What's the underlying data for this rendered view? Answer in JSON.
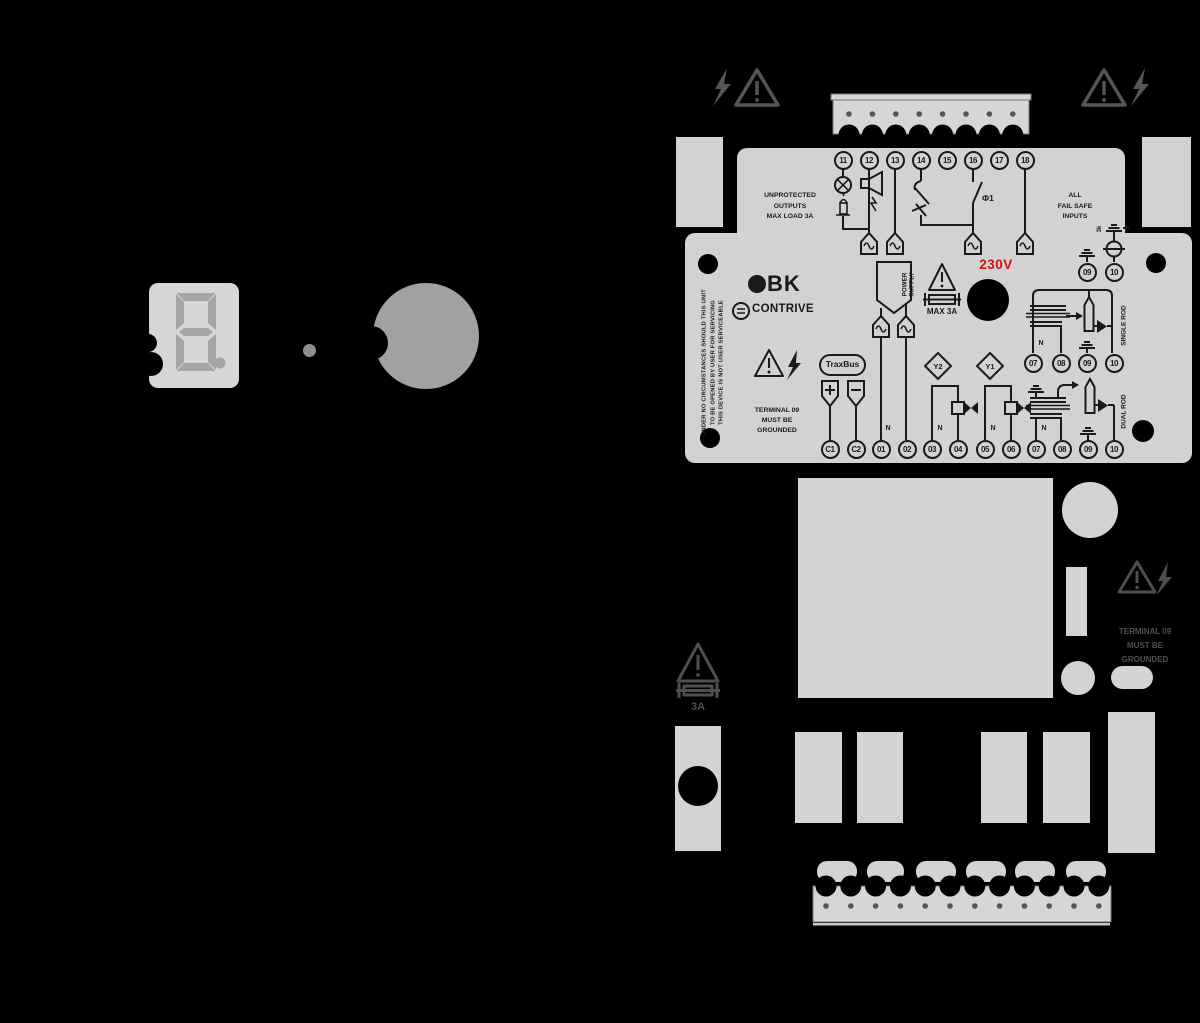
{
  "display": {
    "value": "8."
  },
  "brand": {
    "logo": "BK",
    "company": "CONTRIVE"
  },
  "labels": {
    "unprotected": [
      "UNPROTECTED",
      "OUTPUTS",
      "MAX LOAD 3A"
    ],
    "failsafe": [
      "ALL",
      "FAIL SAFE",
      "INPUTS"
    ],
    "ground_warning": [
      "TERMINAL 09",
      "MUST BE",
      "GROUNDED"
    ],
    "disclaimer": [
      "UNDER NO CIRCUMSTANCES SHOULD THIS UNIT",
      "TO BE OPENED BY USER FOR SERVICING",
      "THIS DEVICE IS NOT USER SERVICEABLE"
    ],
    "power_supply": [
      "POWER",
      "SUPPLY"
    ],
    "voltage": "230V",
    "max_current": "MAX 3A",
    "traxbus": "TraxBus",
    "phase": "Φ1",
    "single_rod": "SINGLE ROD",
    "dual_rod": "DUAL ROD",
    "spark_gap": "3k",
    "fuse_rating": "3A",
    "neutral": "N",
    "valve_y1": "Y1",
    "valve_y2": "Y2"
  },
  "terminals": {
    "top": [
      "11",
      "12",
      "13",
      "14",
      "15",
      "16",
      "17",
      "18"
    ],
    "bottom": [
      "C1",
      "C2",
      "01",
      "02",
      "03",
      "04",
      "05",
      "06",
      "07",
      "08",
      "09",
      "10"
    ],
    "single_rod_row": [
      "07",
      "08",
      "09",
      "10"
    ],
    "surge_pair": [
      "09",
      "10"
    ]
  },
  "colors": {
    "panel": "#d2d2d2",
    "ink": "#1a1a1a",
    "accent_red": "#cc1111",
    "background": "#000000",
    "muted_icon": "#565656"
  }
}
